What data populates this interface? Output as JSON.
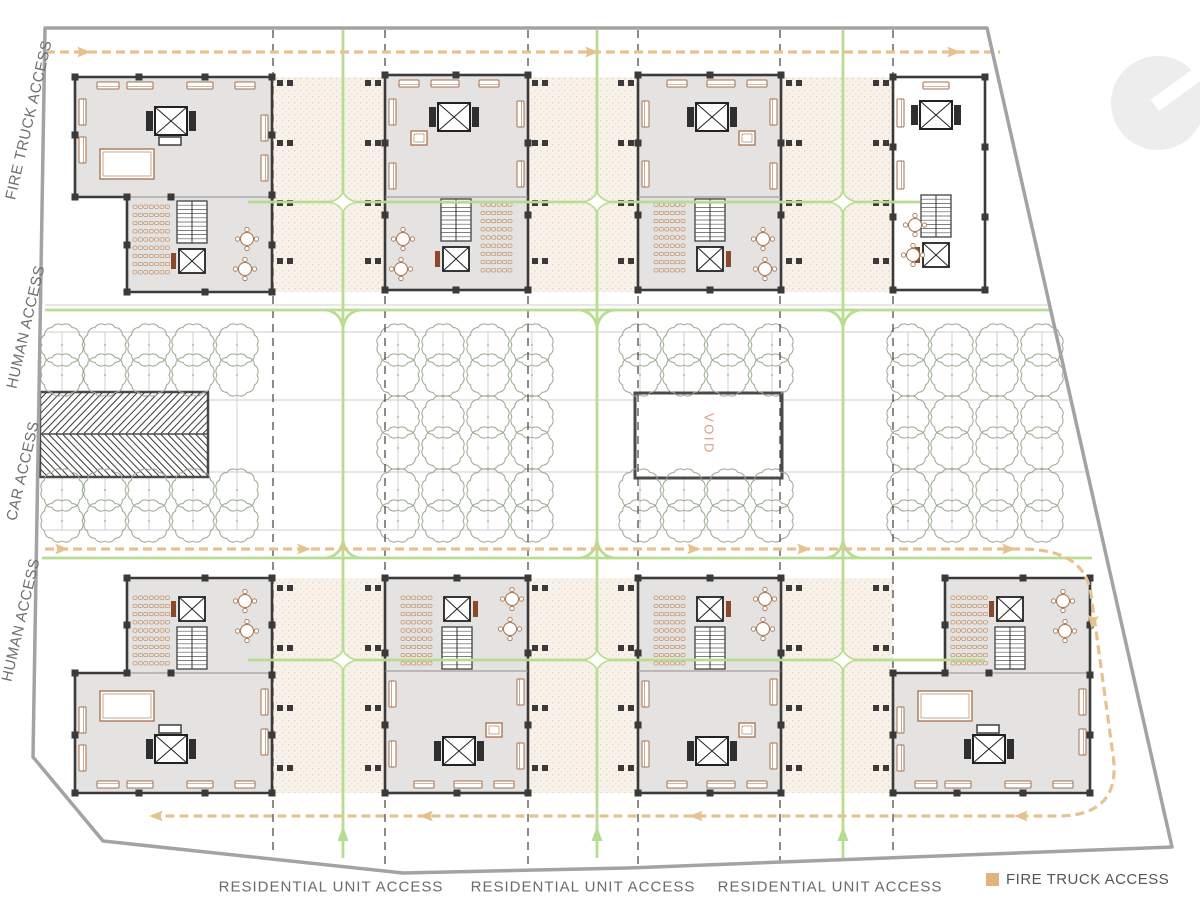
{
  "plan": {
    "access_labels": {
      "fire_truck": "FIRE TRUCK ACCESS",
      "human_top": "HUMAN ACCESS",
      "car": "CAR  ACCESS",
      "human_bottom": "HUMAN ACCESS"
    },
    "residential_labels": [
      "RESIDENTIAL UNIT ACCESS",
      "RESIDENTIAL UNIT ACCESS",
      "RESIDENTIAL UNIT ACCESS"
    ],
    "void_label": "VOID",
    "legend": {
      "label": "FIRE TRUCK ACCESS",
      "swatch_color": "#dfb57f"
    },
    "colors": {
      "fire_truck_path": "#e6c291",
      "human_path": "#b9dd90",
      "building_fill": "#e4e3e1",
      "building_fill_alt": "#ffffff",
      "wall": "#3a3a3a",
      "boundary": "#a3a3a3",
      "tree": "#9aa98f",
      "plaza_fill": "#f9f2ea",
      "furniture": "#a5714a",
      "label_text": "#6b6b6b",
      "void_text": "#d8a083"
    }
  }
}
